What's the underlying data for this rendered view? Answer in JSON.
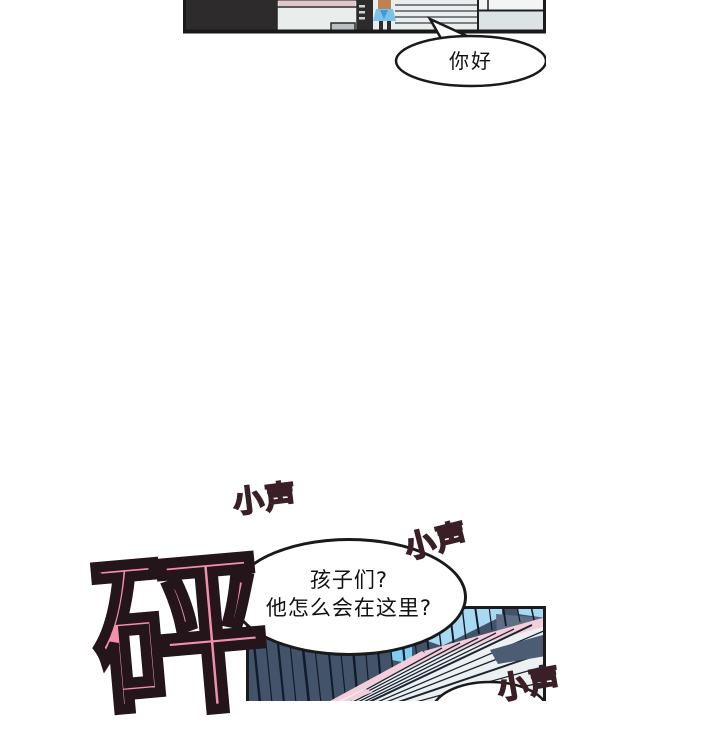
{
  "page": {
    "background": "#ffffff"
  },
  "top_panel": {
    "description": "interior scene with small character",
    "speech_bubble": {
      "text": "你好"
    }
  },
  "dialog_bubble": {
    "line1": "孩子们?",
    "line2": "他怎么会在这里?"
  },
  "sfx": {
    "bang": {
      "text": "砰"
    },
    "whispers": [
      {
        "text": "小声"
      },
      {
        "text": "小声"
      },
      {
        "text": "小声"
      }
    ]
  },
  "colors": {
    "sfx_pink": "#f48fab",
    "whisper_pink": "#ee8fa9",
    "outline_dark": "#23151a",
    "panel_slate": "#43536a",
    "panel_blue": "#a7d9f3",
    "panel_pink_stripe": "#f3cdd9",
    "character_shirt_blue": "#7cc2e8",
    "character_hair": "#bd8152"
  }
}
